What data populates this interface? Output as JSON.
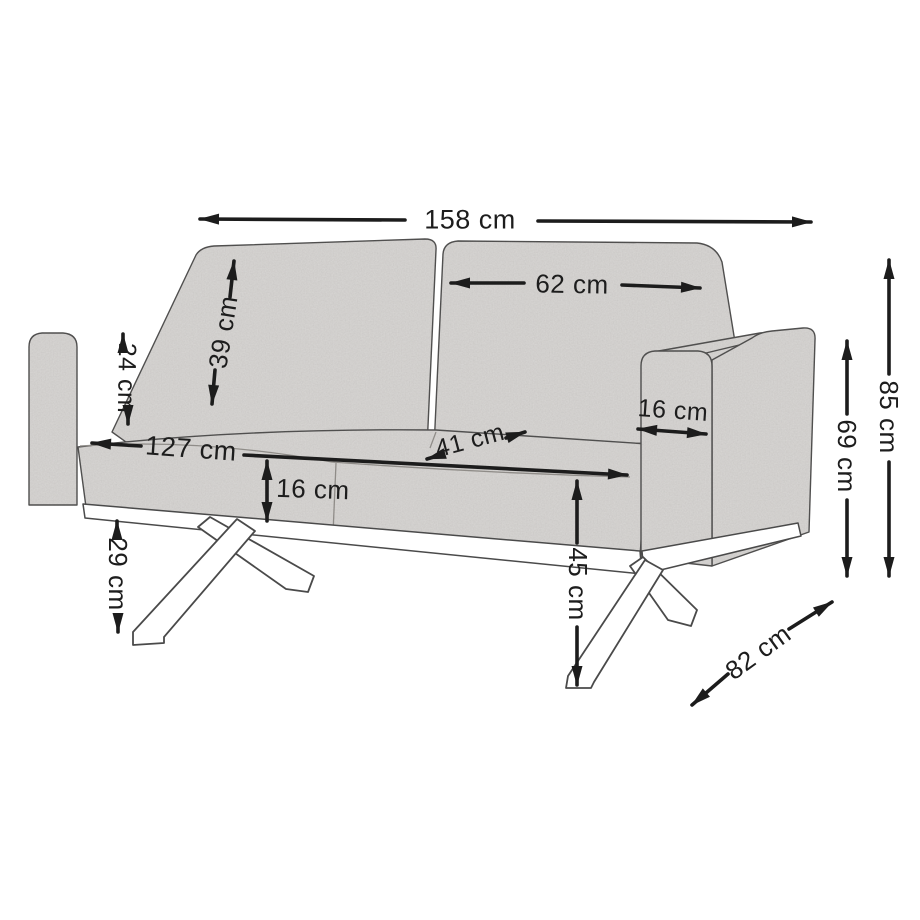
{
  "figure": {
    "subject": "two-seat sofa dimension diagram",
    "colors": {
      "background": "#ffffff",
      "fabric": "#dbd9d7",
      "outline": "#4a4a4a",
      "dimension_line": "#1c1c1c",
      "leg_fill": "#ffffff"
    }
  },
  "dimensions": {
    "overall_width": "158 cm",
    "back_cushion_width": "62 cm",
    "back_cushion_height": "39 cm",
    "armrest_height_above_seat": "24 cm",
    "seat_width": "127 cm",
    "seat_depth": "41 cm",
    "seat_cushion_height": "16 cm",
    "armrest_width": "16 cm",
    "seat_height": "45 cm",
    "underframe_clearance": "29 cm",
    "total_height": "85 cm",
    "armrest_height": "69 cm",
    "total_depth": "82 cm"
  }
}
